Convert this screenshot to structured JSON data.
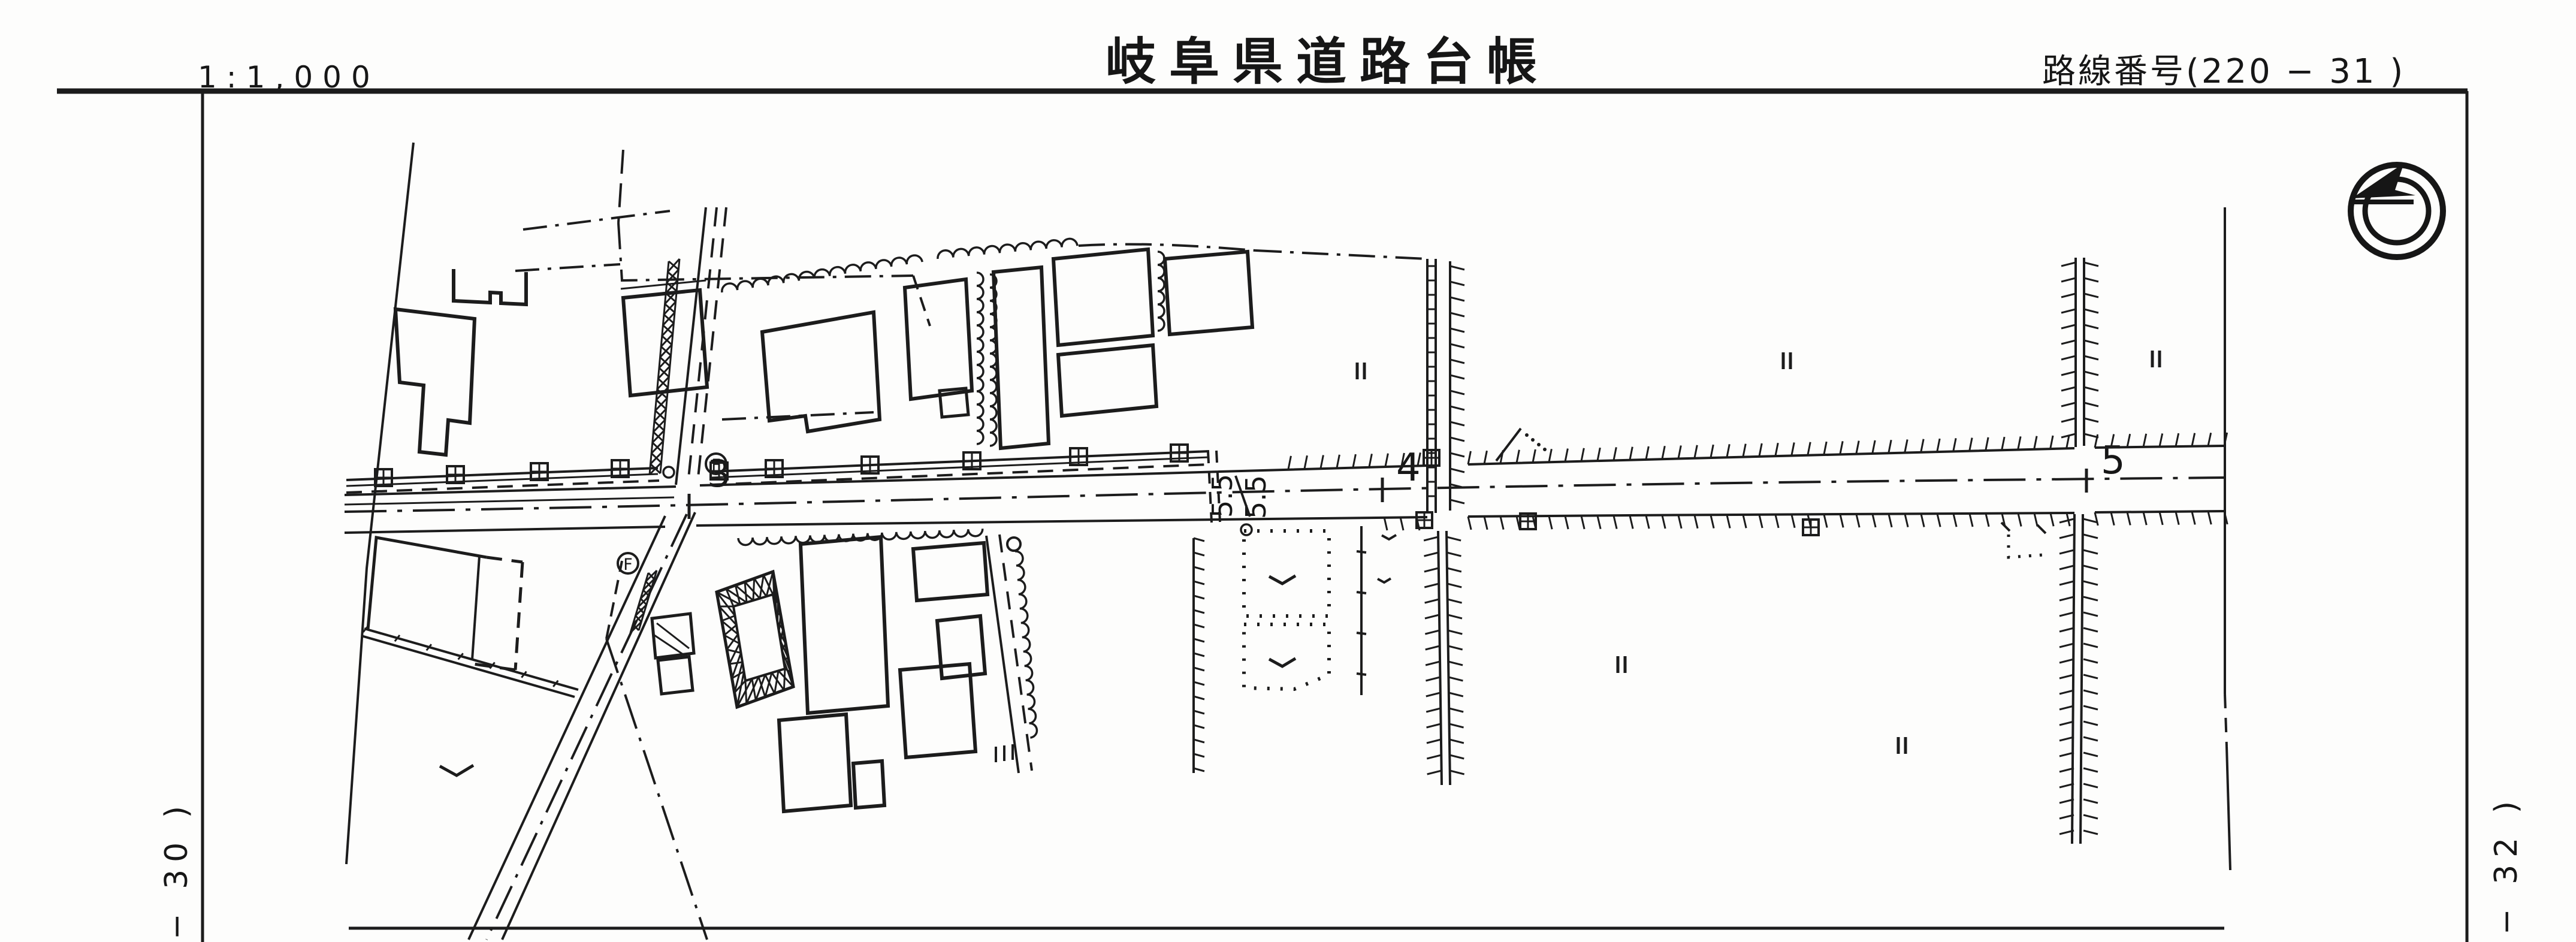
{
  "header": {
    "scale_label": "1:1,000",
    "title": "岐阜県道路台帳",
    "route_label": "路線番号(220 − 31 )"
  },
  "margins": {
    "left_ref": "− 30 )",
    "right_ref": "− 32 )"
  },
  "map": {
    "stations": [
      {
        "label": "3"
      },
      {
        "label": "4"
      },
      {
        "label": "5"
      }
    ],
    "width_annotations": [
      {
        "value": "5.5"
      },
      {
        "value": "5.5"
      }
    ],
    "hydrant": {
      "label": "F"
    },
    "colors": {
      "ink": "#1c1c1c",
      "paper": "#fdfdfc"
    }
  }
}
